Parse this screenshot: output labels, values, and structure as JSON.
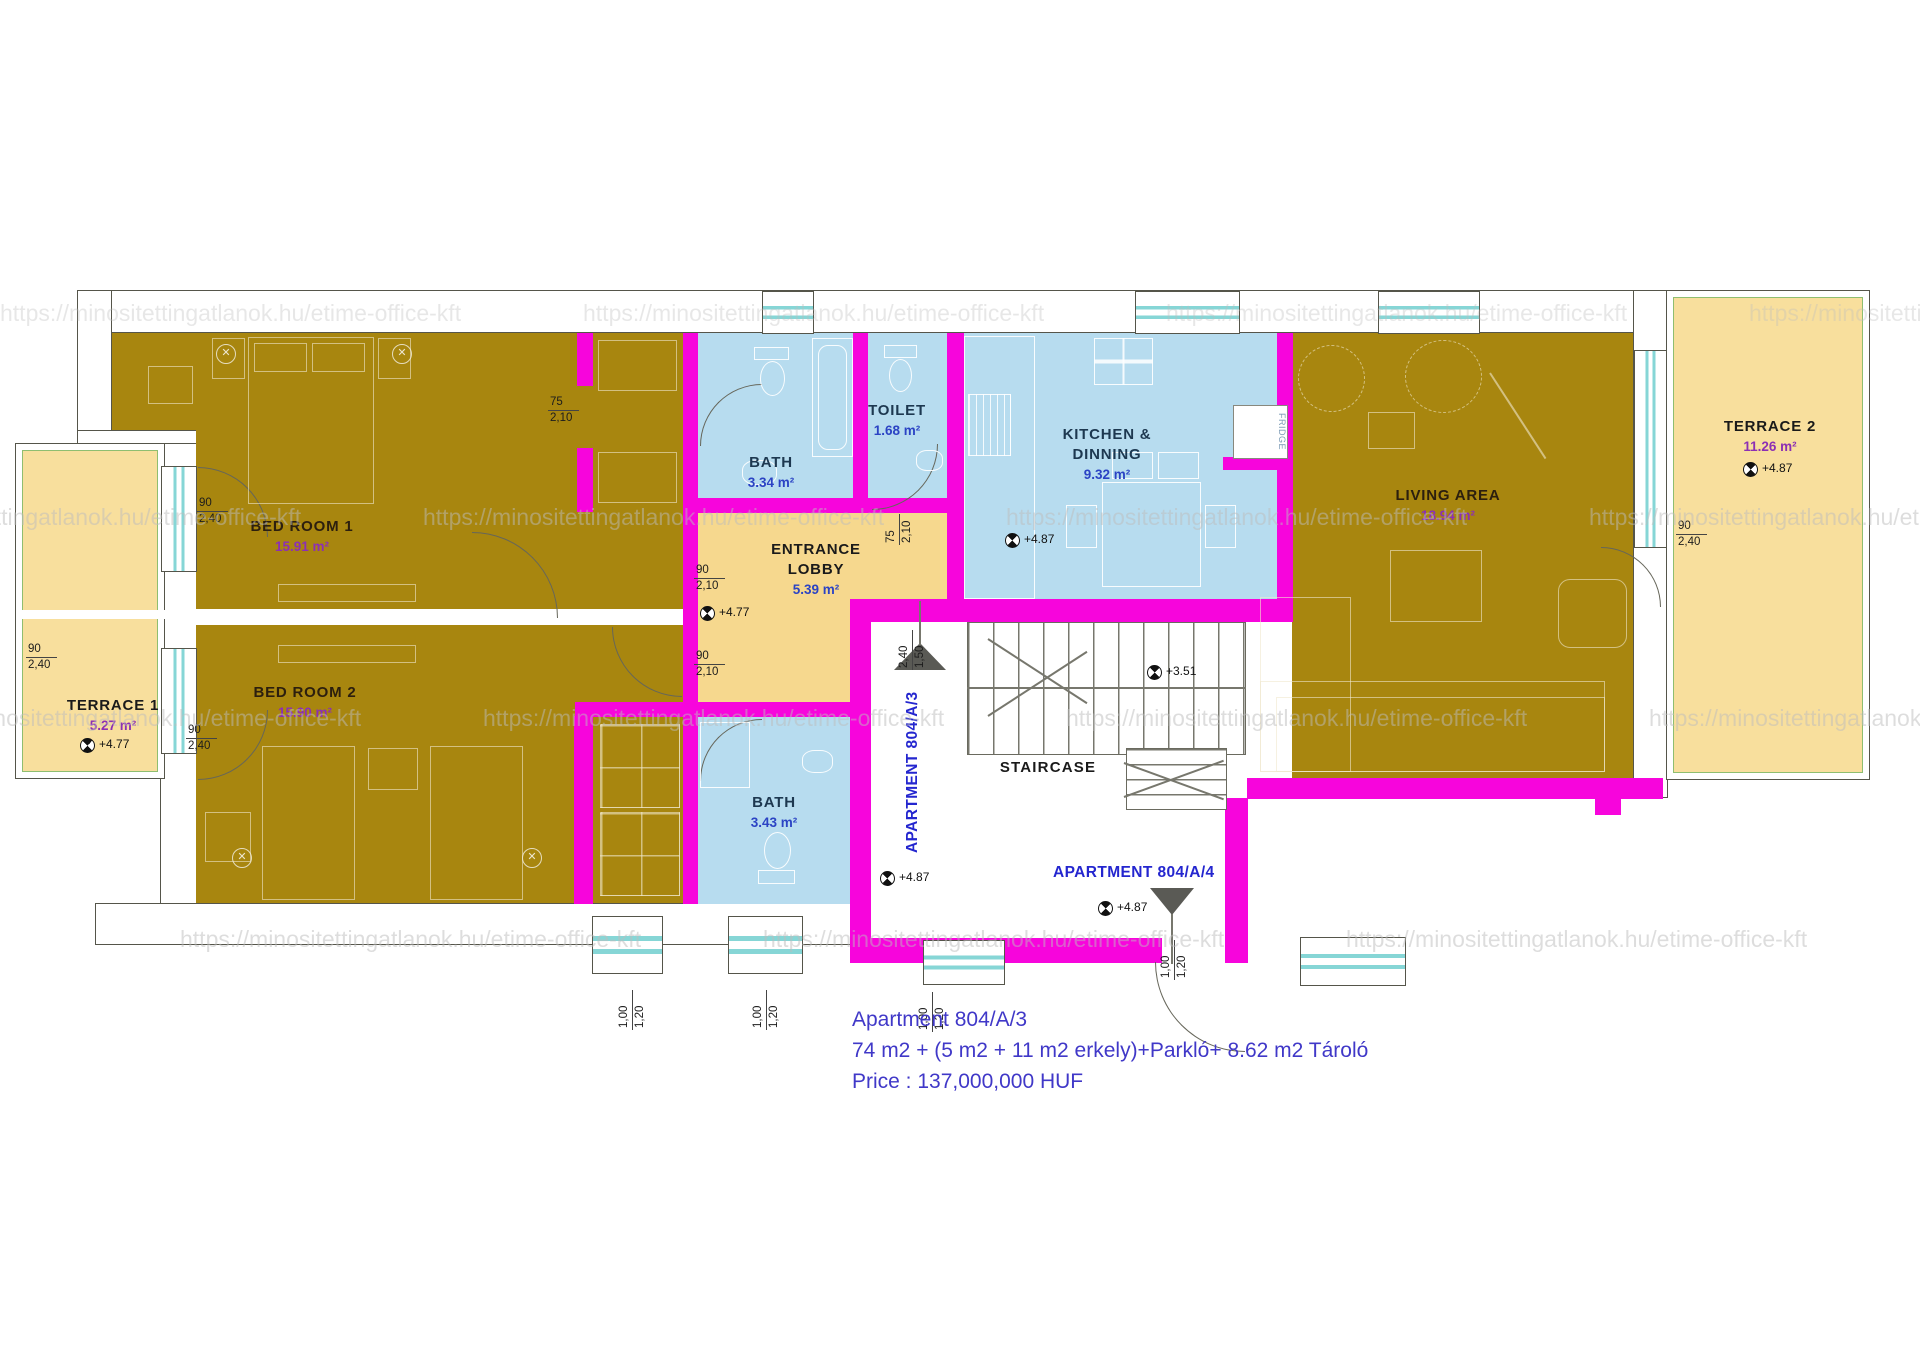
{
  "watermark": {
    "text": "https://minositettingatlanok.hu/etime-office-kft"
  },
  "icons": {
    "fan": "✕"
  },
  "rooms": {
    "terrace1": {
      "name": "TERRACE 1",
      "area": "5.27 m²",
      "elevation": "+4.77"
    },
    "terrace2": {
      "name": "TERRACE 2",
      "area": "11.26 m²",
      "elevation": "+4.87"
    },
    "bedroom1": {
      "name": "BED ROOM 1",
      "area": "15.91 m²"
    },
    "bedroom2": {
      "name": "BED ROOM 2",
      "area": "15.90 m²"
    },
    "bath1": {
      "name": "BATH",
      "area": "3.34 m²"
    },
    "toilet": {
      "name": "TOILET",
      "area": "1.68 m²"
    },
    "kitchen": {
      "name_line1": "KITCHEN &",
      "name_line2": "DINNING",
      "area": "9.32 m²",
      "elevation": "+4.87"
    },
    "lobby": {
      "name_line1": "ENTRANCE",
      "name_line2": "LOBBY",
      "area": "5.39 m²",
      "elevation": "+4.77"
    },
    "living": {
      "name": "LIVING AREA",
      "area": "18.94 m²"
    },
    "bath2": {
      "name": "BATH",
      "area": "3.43 m²"
    },
    "staircase": {
      "name": "STAIRCASE",
      "elevation": "+3.51"
    }
  },
  "apartments": {
    "a3": {
      "label": "APARTMENT 804/A/3",
      "entry_elevation": "+4.87"
    },
    "a4": {
      "label": "APARTMENT 804/A/4",
      "entry_elevation": "+4.87"
    }
  },
  "fixtures": {
    "fridge": "FRIDGE"
  },
  "dimensions": {
    "bath1_door": {
      "top": "75",
      "bottom": "2,10"
    },
    "toilet_door": {
      "top": "75",
      "bottom": "2,10"
    },
    "lobby_door_upper": {
      "top": "90",
      "bottom": "2,10"
    },
    "lobby_door_lower": {
      "top": "90",
      "bottom": "2,10"
    },
    "terrace1_window_upper": {
      "top": "90",
      "bottom": "2,40"
    },
    "terrace1_window_lower": {
      "top": "90",
      "bottom": "2,40"
    },
    "terrace1_inner": {
      "top": "90",
      "bottom": "2,40"
    },
    "terrace2_window": {
      "top": "90",
      "bottom": "2,40"
    },
    "stair_entry_a3": {
      "top": "2,40",
      "bottom": "1,50"
    },
    "window_b1": {
      "top": "1,00",
      "bottom": "1,20"
    },
    "window_b2": {
      "top": "1,00",
      "bottom": "1,20"
    },
    "window_b3": {
      "top": "1,00",
      "bottom": "1,20"
    },
    "entry_a4": {
      "top": "1,00",
      "bottom": "1,20"
    }
  },
  "footer": {
    "line1": "Apartment 804/A/3",
    "line2": "74 m2 + (5 m2 + 11 m2 erkely)+Parkló+ 8.62 m2 Tároló",
    "line3": "Price : 137,000,000 HUF"
  }
}
